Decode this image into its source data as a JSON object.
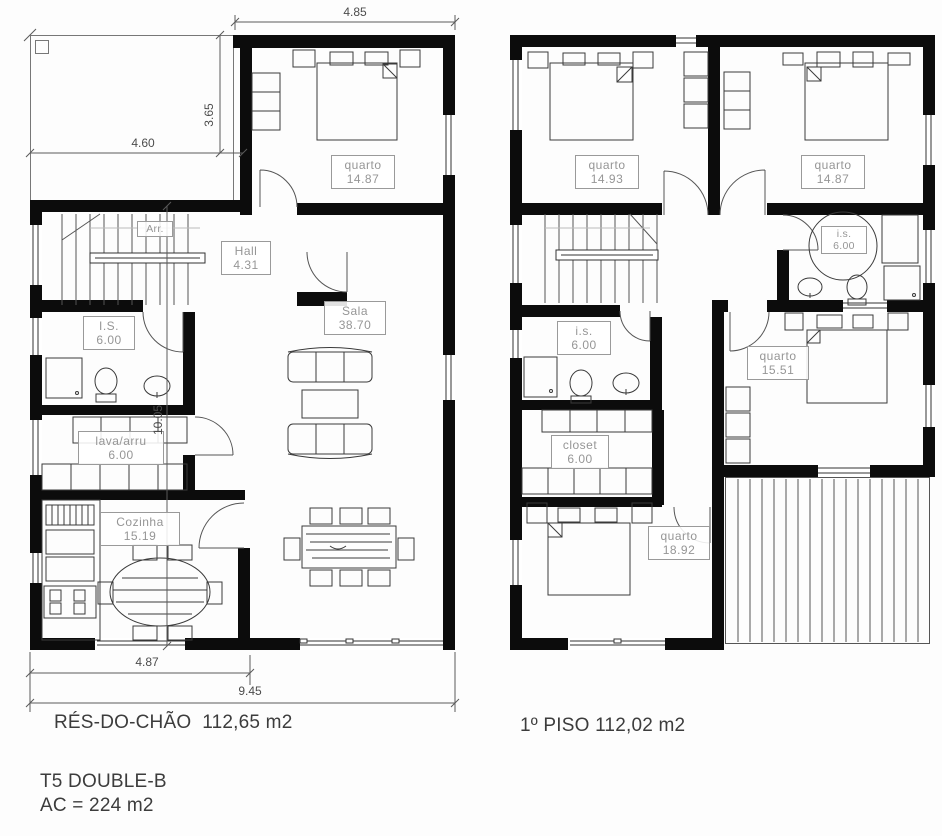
{
  "drawing": {
    "floor_left": {
      "name_label": "RÉS-DO-CHÃO",
      "area_label": "112,65 m2",
      "rooms": {
        "quarto": {
          "name": "quarto",
          "area": "14.87"
        },
        "arr": {
          "name": "Arr."
        },
        "hall": {
          "name": "Hall",
          "area": "4.31"
        },
        "is": {
          "name": "I.S.",
          "area": "6.00"
        },
        "lava": {
          "name": "lava/arru",
          "area": "6.00"
        },
        "cozinha": {
          "name": "Cozinha",
          "area": "15.19"
        },
        "sala": {
          "name": "Sala",
          "area": "38.70"
        }
      },
      "dimensions": {
        "top": "4.85",
        "carport_width": "4.60",
        "carport_height": "3.65",
        "interior_height": "10.05",
        "bottom_inner": "4.87",
        "bottom_total": "9.45"
      }
    },
    "floor_right": {
      "name_label": "1º PISO",
      "area_label": "112,02 m2",
      "rooms": {
        "quarto1": {
          "name": "quarto",
          "area": "14.93"
        },
        "quarto2": {
          "name": "quarto",
          "area": "14.87"
        },
        "is1": {
          "name": "i.s.",
          "area": "6.00"
        },
        "is2": {
          "name": "i.s.",
          "area": "6.00"
        },
        "quarto3": {
          "name": "quarto",
          "area": "15.51"
        },
        "closet": {
          "name": "closet",
          "area": "6.00"
        },
        "quarto4": {
          "name": "quarto",
          "area": "18.92"
        }
      }
    },
    "footer": {
      "model": "T5 DOUBLE-B",
      "ac": "AC = 224 m2"
    }
  }
}
